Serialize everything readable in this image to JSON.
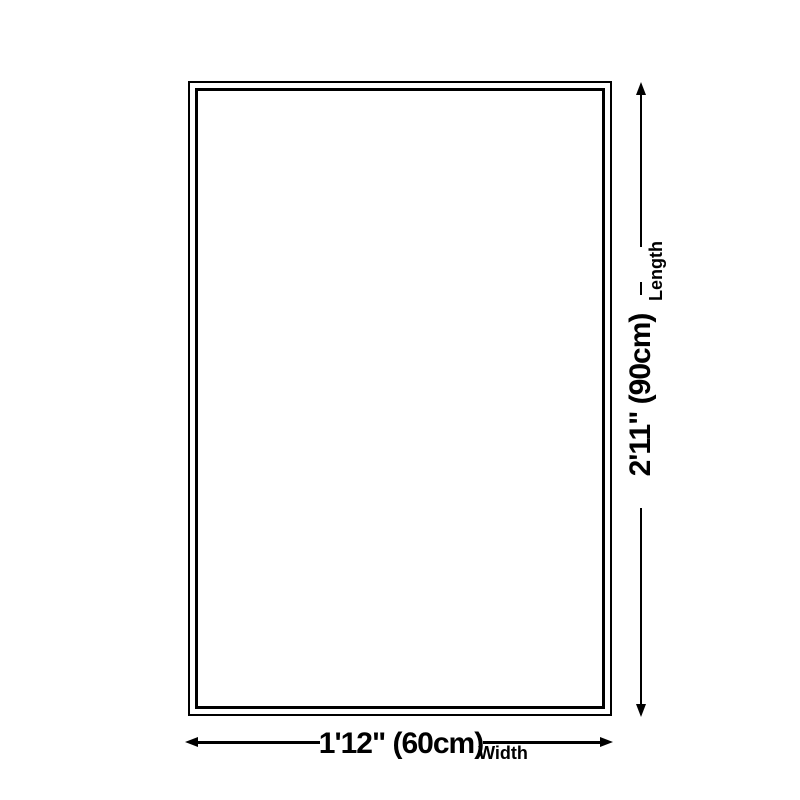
{
  "page": {
    "background": "#ffffff"
  },
  "diagram": {
    "kind": "rug-size-dimension-diagram",
    "line_color": "#000000",
    "length": {
      "value": "2'11\" (90cm)",
      "label": "Length"
    },
    "width": {
      "value": "1'12\" (60cm)",
      "label": "Width"
    }
  }
}
